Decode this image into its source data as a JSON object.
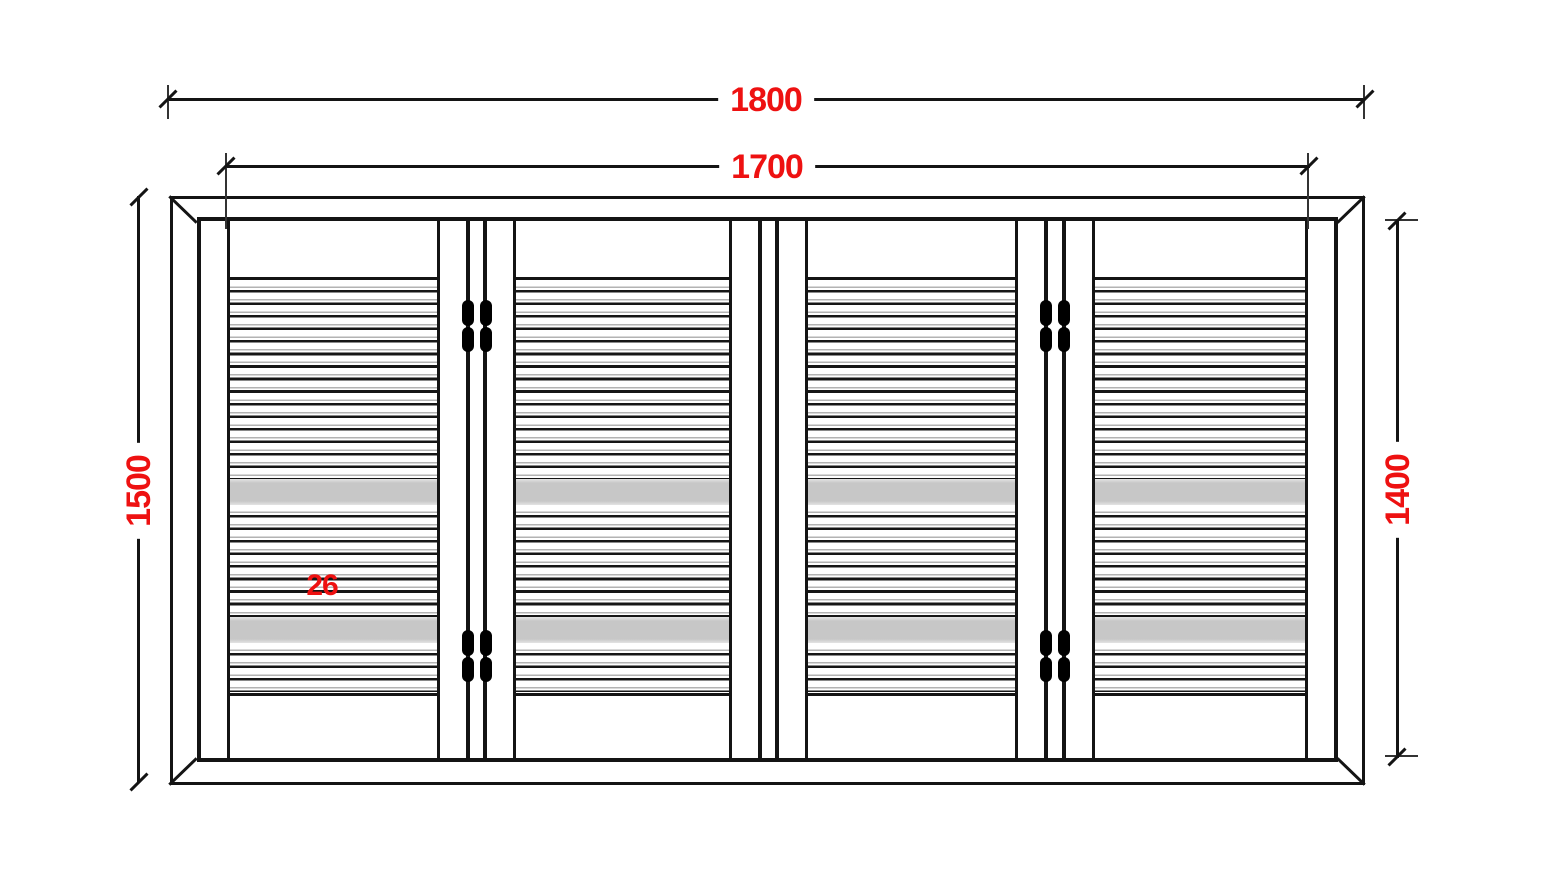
{
  "dimensions": {
    "top_outer": "1800",
    "top_inner": "1700",
    "left_outer": "1500",
    "right_inner": "1400",
    "louver_detail": "26"
  },
  "colors": {
    "dim_red": "#ee1111",
    "line_black": "#141414",
    "band_gray": "#c7c7c7"
  }
}
